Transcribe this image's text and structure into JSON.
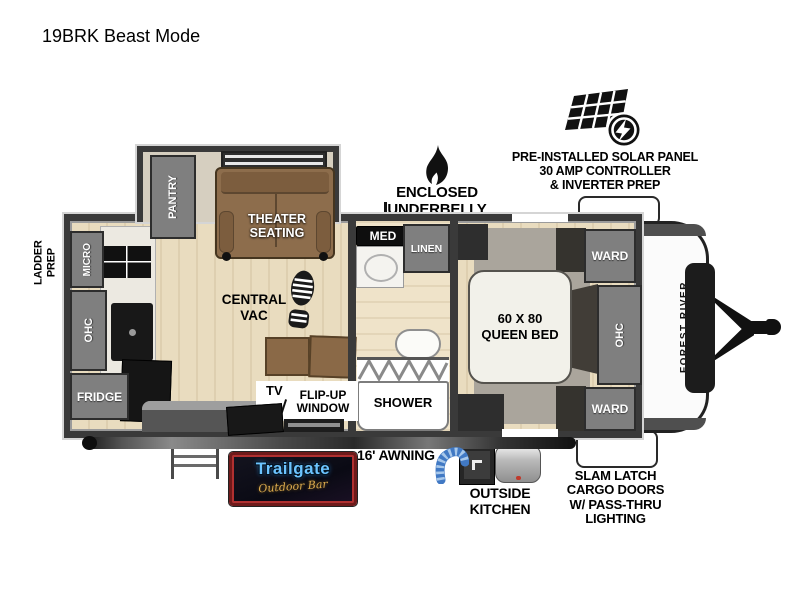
{
  "title": "19BRK Beast Mode",
  "annotations": {
    "solar": {
      "line1": "PRE-INSTALLED SOLAR PANEL",
      "line2": "30 AMP CONTROLLER",
      "line3": "& INVERTER PREP"
    },
    "underbelly": {
      "line1": "ENCLOSED UNDERBELLY",
      "line2": "W/ FORCED HEAT"
    },
    "slam": {
      "line1": "SLAM LATCH",
      "line2": "CARGO DOORS",
      "line3": "W/ PASS-THRU",
      "line4": "LIGHTING"
    },
    "outside_kitchen": {
      "line1": "OUTSIDE",
      "line2": "KITCHEN"
    },
    "awning": "16' AWNING",
    "ladder": {
      "line1": "LADDER",
      "line2": "PREP"
    }
  },
  "floorplan": {
    "pantry": "PANTRY",
    "theater": {
      "line1": "THEATER",
      "line2": "SEATING"
    },
    "micro": "MICRO",
    "kitchen_ohc": "OHC",
    "fridge": "FRIDGE",
    "central_vac": {
      "line1": "CENTRAL",
      "line2": "VAC"
    },
    "tv": "TV",
    "flip_window": {
      "line1": "FLIP-UP",
      "line2": "WINDOW"
    },
    "med": "MED",
    "linen": "LINEN",
    "shower": "SHOWER",
    "bed": {
      "line1": "60 X 80",
      "line2": "QUEEN BED"
    },
    "ward_top": "WARD",
    "bedroom_ohc": "OHC",
    "ward_bottom": "WARD",
    "brand": "FOREST RIVER"
  },
  "logo": {
    "name": "Trailgate",
    "subtitle": "Outdoor Bar"
  },
  "colors": {
    "wall": "#3a3a3a",
    "cabinet_gray": "#7f7f7f",
    "floor_wood": "#e9dcbf",
    "sofa_brown": "#8d6d4c",
    "logo_blue": "#6cc4ff",
    "logo_gold": "#dcab4e",
    "logo_border": "#6e1a1a",
    "hose_blue": "#4179c4"
  }
}
